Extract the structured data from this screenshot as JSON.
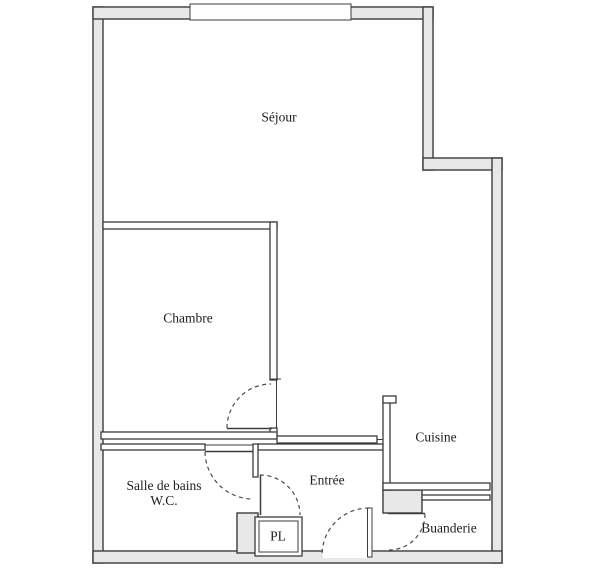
{
  "plan_title": "Apartment floor plan",
  "colors": {
    "wall_fill": "#e8e8e8",
    "line": "#3c3c3c",
    "background": "#ffffff",
    "text": "#1c1c1c"
  },
  "rooms": [
    {
      "id": "sejour",
      "label": "Séjour"
    },
    {
      "id": "chambre",
      "label": "Chambre"
    },
    {
      "id": "cuisine",
      "label": "Cuisine"
    },
    {
      "id": "salle_de_bains",
      "label": "Salle de bains",
      "label2": "W.C."
    },
    {
      "id": "entree",
      "label": "Entrée"
    },
    {
      "id": "pl",
      "label": "PL"
    },
    {
      "id": "buanderie",
      "label": "Buanderie"
    }
  ]
}
